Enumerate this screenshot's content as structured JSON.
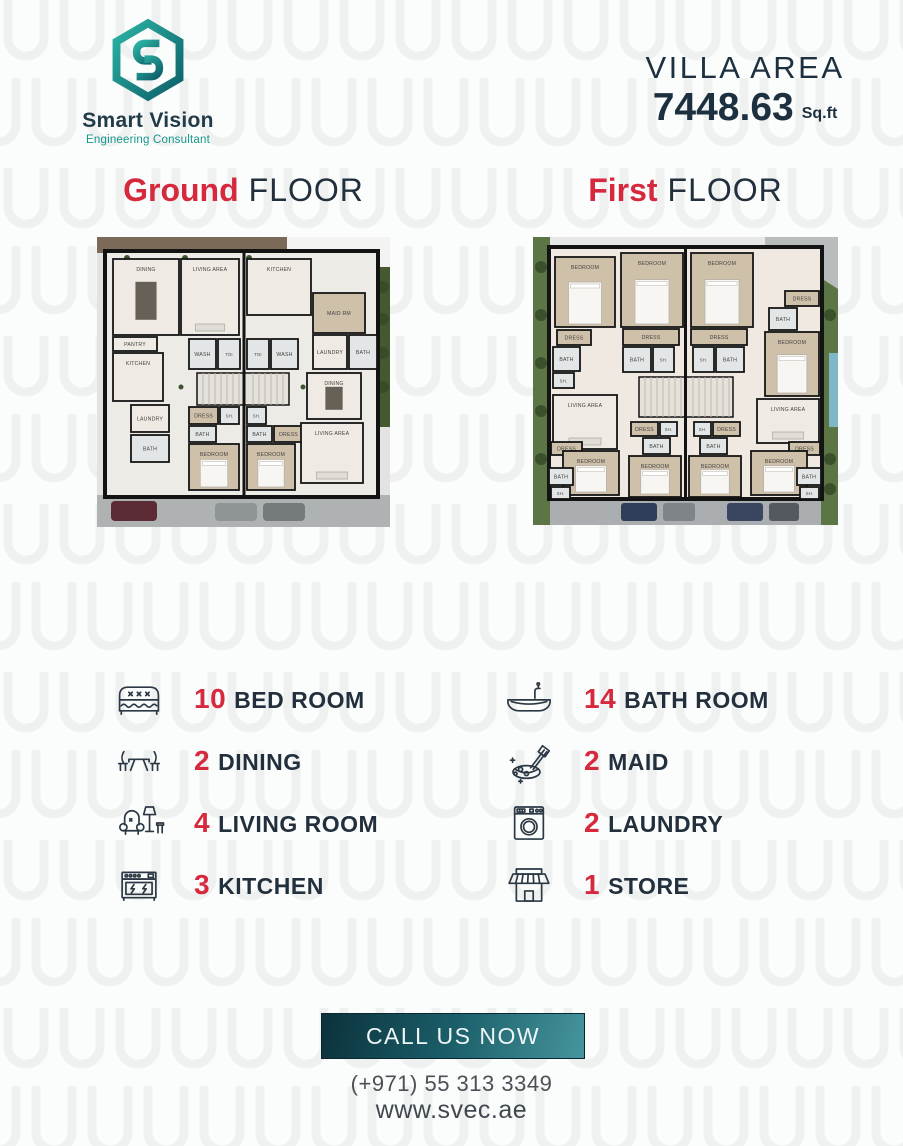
{
  "header": {
    "logo": {
      "name": "Smart Vision",
      "tagline": "Engineering Consultant"
    },
    "villa_area_label": "VILLA AREA",
    "villa_area_value": "7448.63",
    "villa_area_unit": "Sq.ft"
  },
  "floors": {
    "ground": {
      "accent": "Ground",
      "rest": "FLOOR"
    },
    "first": {
      "accent": "First",
      "rest": "FLOOR"
    }
  },
  "plans": {
    "ground": {
      "rooms": [
        {
          "label": "DINING",
          "x": 16,
          "y": 22,
          "w": 66,
          "h": 76
        },
        {
          "label": "LIVING AREA",
          "x": 84,
          "y": 22,
          "w": 58,
          "h": 76
        },
        {
          "label": "KITCHEN",
          "x": 150,
          "y": 22,
          "w": 64,
          "h": 56
        },
        {
          "label": "MAID RM",
          "x": 216,
          "y": 56,
          "w": 52,
          "h": 40,
          "f": "wood"
        },
        {
          "label": "LAUNDRY",
          "x": 216,
          "y": 98,
          "w": 34,
          "h": 34
        },
        {
          "label": "BATH",
          "x": 252,
          "y": 98,
          "w": 28,
          "h": 34,
          "f": "tile"
        },
        {
          "label": "PANTRY",
          "x": 16,
          "y": 100,
          "w": 44,
          "h": 14
        },
        {
          "label": "KITCHEN",
          "x": 16,
          "y": 116,
          "w": 50,
          "h": 48
        },
        {
          "label": "WASH",
          "x": 92,
          "y": 102,
          "w": 27,
          "h": 30,
          "f": "tile"
        },
        {
          "label": "TOI",
          "x": 121,
          "y": 102,
          "w": 22,
          "h": 30,
          "f": "tile"
        },
        {
          "label": "TOI",
          "x": 150,
          "y": 102,
          "w": 22,
          "h": 30,
          "f": "tile"
        },
        {
          "label": "WASH",
          "x": 174,
          "y": 102,
          "w": 27,
          "h": 30,
          "f": "tile"
        },
        {
          "label": "DINING",
          "x": 210,
          "y": 136,
          "w": 54,
          "h": 46
        },
        {
          "label": "LAUNDRY",
          "x": 34,
          "y": 168,
          "w": 38,
          "h": 27
        },
        {
          "label": "BATH",
          "x": 34,
          "y": 198,
          "w": 38,
          "h": 27,
          "f": "tile"
        },
        {
          "label": "DRESS",
          "x": 92,
          "y": 170,
          "w": 29,
          "h": 17,
          "f": "wood"
        },
        {
          "label": "SH.",
          "x": 123,
          "y": 170,
          "w": 19,
          "h": 17,
          "f": "tile"
        },
        {
          "label": "BATH",
          "x": 92,
          "y": 189,
          "w": 27,
          "h": 16,
          "f": "tile"
        },
        {
          "label": "SH.",
          "x": 150,
          "y": 170,
          "w": 19,
          "h": 17,
          "f": "tile"
        },
        {
          "label": "BATH",
          "x": 150,
          "y": 189,
          "w": 25,
          "h": 16,
          "f": "tile"
        },
        {
          "label": "DRESS",
          "x": 177,
          "y": 189,
          "w": 29,
          "h": 16,
          "f": "wood"
        },
        {
          "label": "BEDROOM",
          "x": 92,
          "y": 207,
          "w": 50,
          "h": 46,
          "f": "wood"
        },
        {
          "label": "BEDROOM",
          "x": 150,
          "y": 207,
          "w": 48,
          "h": 46,
          "f": "wood"
        },
        {
          "label": "LIVING AREA",
          "x": 204,
          "y": 186,
          "w": 62,
          "h": 60
        }
      ]
    },
    "first": {
      "rooms": [
        {
          "label": "BEDROOM",
          "x": 22,
          "y": 20,
          "w": 60,
          "h": 70,
          "f": "wood"
        },
        {
          "label": "BEDROOM",
          "x": 88,
          "y": 16,
          "w": 62,
          "h": 74,
          "f": "wood"
        },
        {
          "label": "BEDROOM",
          "x": 158,
          "y": 16,
          "w": 62,
          "h": 74,
          "f": "wood"
        },
        {
          "label": "DRESS",
          "x": 252,
          "y": 54,
          "w": 34,
          "h": 15,
          "f": "wood"
        },
        {
          "label": "BATH",
          "x": 236,
          "y": 71,
          "w": 28,
          "h": 22,
          "f": "tile"
        },
        {
          "label": "BEDROOM",
          "x": 232,
          "y": 95,
          "w": 54,
          "h": 64,
          "f": "wood"
        },
        {
          "label": "DRESS",
          "x": 24,
          "y": 93,
          "w": 34,
          "h": 15,
          "f": "wood"
        },
        {
          "label": "BATH",
          "x": 20,
          "y": 110,
          "w": 27,
          "h": 24,
          "f": "tile"
        },
        {
          "label": "SH.",
          "x": 20,
          "y": 136,
          "w": 21,
          "h": 15,
          "f": "tile"
        },
        {
          "label": "DRESS",
          "x": 90,
          "y": 92,
          "w": 56,
          "h": 16,
          "f": "wood"
        },
        {
          "label": "DRESS",
          "x": 158,
          "y": 92,
          "w": 56,
          "h": 16,
          "f": "wood"
        },
        {
          "label": "BATH",
          "x": 90,
          "y": 110,
          "w": 28,
          "h": 25,
          "f": "tile"
        },
        {
          "label": "SH.",
          "x": 120,
          "y": 110,
          "w": 21,
          "h": 25,
          "f": "tile"
        },
        {
          "label": "SH.",
          "x": 160,
          "y": 110,
          "w": 21,
          "h": 25,
          "f": "tile"
        },
        {
          "label": "BATH",
          "x": 183,
          "y": 110,
          "w": 28,
          "h": 25,
          "f": "tile"
        },
        {
          "label": "LIVING AREA",
          "x": 20,
          "y": 158,
          "w": 64,
          "h": 54
        },
        {
          "label": "LIVING AREA",
          "x": 224,
          "y": 162,
          "w": 62,
          "h": 44
        },
        {
          "label": "DRESS",
          "x": 98,
          "y": 185,
          "w": 27,
          "h": 14,
          "f": "wood"
        },
        {
          "label": "SH.",
          "x": 127,
          "y": 185,
          "w": 17,
          "h": 14,
          "f": "tile"
        },
        {
          "label": "SH.",
          "x": 161,
          "y": 185,
          "w": 17,
          "h": 14,
          "f": "tile"
        },
        {
          "label": "DRESS",
          "x": 180,
          "y": 185,
          "w": 27,
          "h": 14,
          "f": "wood"
        },
        {
          "label": "BATH",
          "x": 110,
          "y": 201,
          "w": 27,
          "h": 16,
          "f": "tile"
        },
        {
          "label": "BATH",
          "x": 167,
          "y": 201,
          "w": 27,
          "h": 16,
          "f": "tile"
        },
        {
          "label": "DRESS",
          "x": 18,
          "y": 205,
          "w": 31,
          "h": 13,
          "f": "wood"
        },
        {
          "label": "DRESS",
          "x": 256,
          "y": 205,
          "w": 31,
          "h": 13,
          "f": "wood"
        },
        {
          "label": "BEDROOM",
          "x": 30,
          "y": 214,
          "w": 56,
          "h": 44,
          "f": "wood"
        },
        {
          "label": "BEDROOM",
          "x": 96,
          "y": 219,
          "w": 52,
          "h": 41,
          "f": "wood"
        },
        {
          "label": "BEDROOM",
          "x": 156,
          "y": 219,
          "w": 52,
          "h": 41,
          "f": "wood"
        },
        {
          "label": "BEDROOM",
          "x": 218,
          "y": 214,
          "w": 56,
          "h": 44,
          "f": "wood"
        },
        {
          "label": "BATH",
          "x": 16,
          "y": 231,
          "w": 24,
          "h": 17,
          "f": "tile"
        },
        {
          "label": "SH.",
          "x": 18,
          "y": 250,
          "w": 19,
          "h": 12,
          "f": "tile"
        },
        {
          "label": "BATH",
          "x": 264,
          "y": 231,
          "w": 24,
          "h": 17,
          "f": "tile"
        },
        {
          "label": "SH.",
          "x": 267,
          "y": 250,
          "w": 19,
          "h": 12,
          "f": "tile"
        }
      ]
    }
  },
  "features": {
    "left": [
      {
        "count": "10",
        "label": "BED ROOM",
        "icon": "bed-icon"
      },
      {
        "count": "2",
        "label": "DINING",
        "icon": "dining-table-icon"
      },
      {
        "count": "4",
        "label": "LIVING ROOM",
        "icon": "armchair-icon"
      },
      {
        "count": "3",
        "label": "KITCHEN",
        "icon": "stove-icon"
      }
    ],
    "right": [
      {
        "count": "14",
        "label": "BATH ROOM",
        "icon": "bathtub-icon"
      },
      {
        "count": "2",
        "label": "MAID",
        "icon": "cleaning-bucket-icon"
      },
      {
        "count": "2",
        "label": "LAUNDRY",
        "icon": "washing-machine-icon"
      },
      {
        "count": "1",
        "label": "STORE",
        "icon": "storefront-icon"
      }
    ]
  },
  "footer": {
    "cta": "CALL US NOW",
    "phone": "(+971) 55 313 3349",
    "website": "www.svec.ae"
  },
  "colors": {
    "accent_red": "#d7293d",
    "heading_navy": "#22303d",
    "brand_teal": "#1b9c90",
    "button_gradient_start": "#0b313b",
    "button_gradient_end": "#46959d"
  }
}
